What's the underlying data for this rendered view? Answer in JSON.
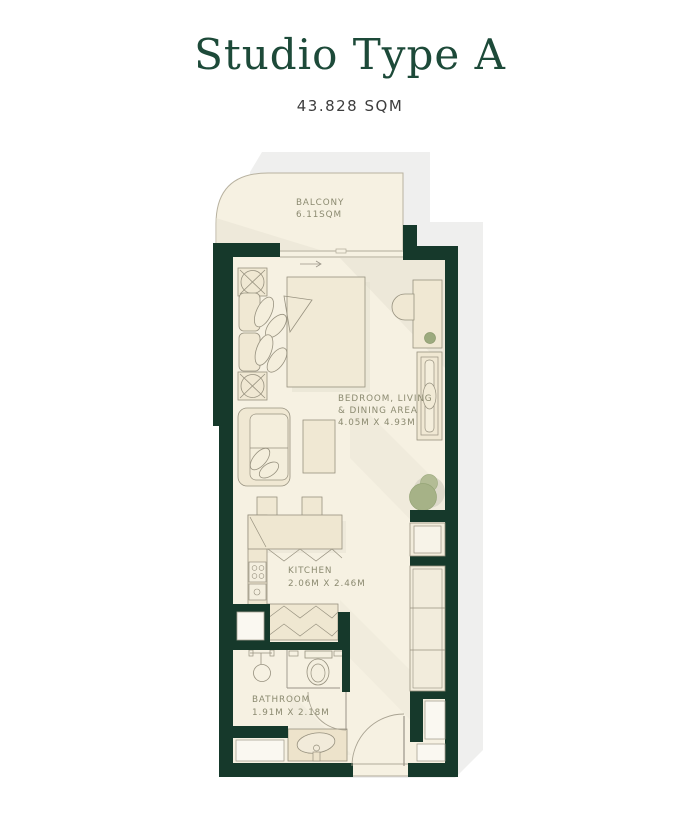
{
  "page": {
    "title": "Studio Type A",
    "subtitle": "43.828 SQM"
  },
  "rooms": {
    "balcony": {
      "label": "BALCONY",
      "area": "6.11SQM"
    },
    "bedroom": {
      "label_line1": "BEDROOM, LIVING",
      "label_line2": "& DINING AREA",
      "dimensions": "4.05M X 4.93M"
    },
    "kitchen": {
      "label": "KITCHEN",
      "dimensions": "2.06M X 2.46M"
    },
    "bathroom": {
      "label": "BATHROOM",
      "dimensions": "1.91M X 2.18M"
    }
  },
  "colors": {
    "title_green": "#1d4a39",
    "wall_green": "#16392b",
    "floor_cream": "#f6f1e2",
    "furniture_cream": "#f0e8d3",
    "exterior_shadow_gray": "#efefee",
    "label_olive": "#8b8a70",
    "plant_green": "#a6b287",
    "subtitle_gray": "#3d3d3d"
  }
}
